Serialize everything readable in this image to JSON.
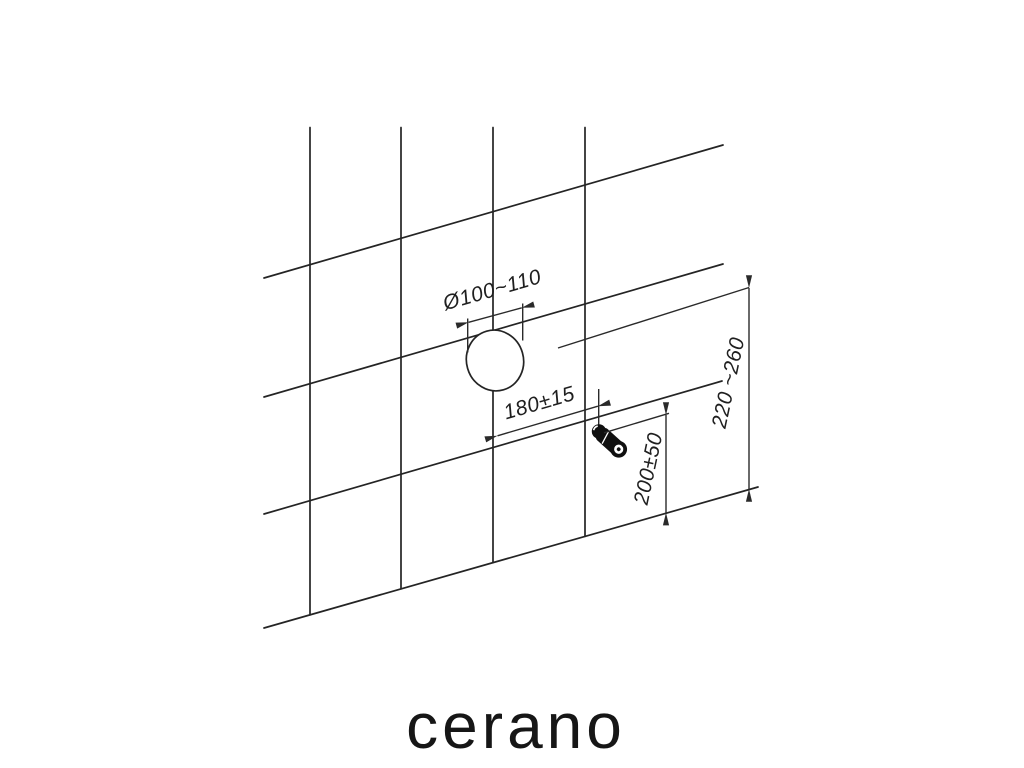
{
  "diagram": {
    "kind": "installation-drawing",
    "dimensions": {
      "drain_diameter": "Ø100~110",
      "horizontal_distance": "180±15",
      "supply_height": "200±50",
      "drain_height": "220 ~260"
    },
    "brand": "cerano",
    "colors": {
      "background": "#ffffff",
      "line": "#242424",
      "dimension_line": "#2a2a2a",
      "text": "#1f1f1f",
      "fixture": "#101010"
    }
  }
}
